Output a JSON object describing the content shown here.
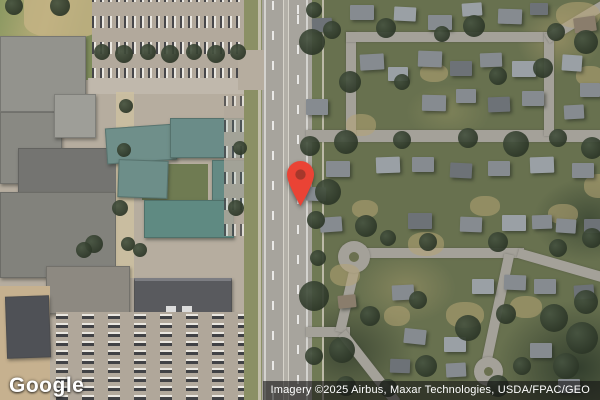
{
  "map": {
    "type": "satellite",
    "logo_text": "Google",
    "attribution_text": "Imagery ©2025 Airbus, Maxar Technologies, USDA/FPAC/GEO",
    "marker": {
      "color": "#EA4335",
      "inner_color": "#A6372B"
    },
    "colors": {
      "vegetation_dark": "#2c3627",
      "lawn_olive": "#68714f",
      "dry_grass": "#b5a474",
      "residential_road": "#a4a199",
      "highway": "#a7a49d",
      "campus_pavement": "#b6ad9f",
      "roof_gray": "#93938d",
      "roof_teal": "#668c86",
      "roof_dark": "#56575b"
    },
    "features": {
      "houses": [
        [
          312,
          18,
          20,
          14,
          -2,
          2
        ],
        [
          350,
          5,
          24,
          15,
          0,
          0
        ],
        [
          394,
          7,
          22,
          14,
          3,
          1
        ],
        [
          428,
          15,
          24,
          15,
          0,
          0
        ],
        [
          462,
          3,
          20,
          13,
          -4,
          1
        ],
        [
          498,
          9,
          24,
          15,
          2,
          0
        ],
        [
          530,
          3,
          18,
          12,
          0,
          2
        ],
        [
          574,
          17,
          22,
          15,
          -8,
          3
        ],
        [
          306,
          99,
          22,
          16,
          0,
          0
        ],
        [
          306,
          187,
          20,
          14,
          2,
          0
        ],
        [
          360,
          54,
          24,
          16,
          -3,
          0
        ],
        [
          388,
          67,
          20,
          14,
          0,
          1
        ],
        [
          418,
          51,
          24,
          16,
          2,
          0
        ],
        [
          450,
          61,
          22,
          15,
          0,
          2
        ],
        [
          480,
          53,
          22,
          14,
          -2,
          0
        ],
        [
          512,
          61,
          24,
          16,
          0,
          1
        ],
        [
          422,
          95,
          24,
          16,
          1,
          0
        ],
        [
          456,
          89,
          20,
          14,
          0,
          0
        ],
        [
          488,
          97,
          22,
          15,
          -2,
          2
        ],
        [
          522,
          91,
          22,
          15,
          0,
          0
        ],
        [
          562,
          55,
          20,
          16,
          4,
          1
        ],
        [
          580,
          83,
          20,
          14,
          0,
          0
        ],
        [
          564,
          105,
          20,
          14,
          -3,
          0
        ],
        [
          326,
          161,
          24,
          16,
          0,
          0
        ],
        [
          376,
          157,
          24,
          16,
          -2,
          1
        ],
        [
          412,
          157,
          22,
          15,
          0,
          0
        ],
        [
          450,
          163,
          22,
          15,
          3,
          2
        ],
        [
          488,
          161,
          22,
          15,
          0,
          0
        ],
        [
          530,
          157,
          24,
          16,
          -2,
          1
        ],
        [
          572,
          163,
          22,
          15,
          0,
          0
        ],
        [
          320,
          217,
          22,
          15,
          -4,
          0
        ],
        [
          408,
          213,
          24,
          16,
          0,
          2
        ],
        [
          460,
          217,
          22,
          15,
          2,
          0
        ],
        [
          502,
          215,
          24,
          16,
          0,
          1
        ],
        [
          532,
          215,
          20,
          14,
          -2,
          0
        ],
        [
          556,
          219,
          20,
          14,
          4,
          0
        ],
        [
          584,
          219,
          18,
          14,
          0,
          2
        ],
        [
          392,
          285,
          22,
          15,
          -3,
          0
        ],
        [
          472,
          279,
          22,
          15,
          0,
          1
        ],
        [
          504,
          275,
          22,
          15,
          2,
          0
        ],
        [
          534,
          279,
          22,
          15,
          0,
          0
        ],
        [
          574,
          285,
          20,
          14,
          -4,
          2
        ],
        [
          404,
          329,
          22,
          15,
          6,
          0
        ],
        [
          444,
          337,
          22,
          15,
          0,
          1
        ],
        [
          446,
          363,
          20,
          14,
          -3,
          0
        ],
        [
          530,
          343,
          22,
          15,
          0,
          0
        ],
        [
          390,
          359,
          20,
          14,
          2,
          2
        ],
        [
          558,
          379,
          22,
          14,
          0,
          0
        ],
        [
          338,
          295,
          18,
          13,
          -6,
          3
        ]
      ],
      "trees": [
        [
          312,
          42,
          26
        ],
        [
          332,
          30,
          18
        ],
        [
          386,
          28,
          20
        ],
        [
          442,
          34,
          16
        ],
        [
          474,
          26,
          22
        ],
        [
          556,
          32,
          18
        ],
        [
          350,
          82,
          22
        ],
        [
          402,
          82,
          16
        ],
        [
          498,
          76,
          18
        ],
        [
          543,
          68,
          20
        ],
        [
          586,
          42,
          24
        ],
        [
          310,
          146,
          20
        ],
        [
          346,
          142,
          24
        ],
        [
          402,
          140,
          18
        ],
        [
          468,
          138,
          20
        ],
        [
          516,
          144,
          26
        ],
        [
          558,
          138,
          18
        ],
        [
          592,
          148,
          22
        ],
        [
          328,
          192,
          26
        ],
        [
          366,
          226,
          22
        ],
        [
          388,
          238,
          16
        ],
        [
          428,
          242,
          18
        ],
        [
          498,
          242,
          20
        ],
        [
          558,
          248,
          18
        ],
        [
          592,
          238,
          20
        ],
        [
          314,
          296,
          30
        ],
        [
          342,
          350,
          26
        ],
        [
          370,
          316,
          20
        ],
        [
          418,
          300,
          18
        ],
        [
          426,
          366,
          22
        ],
        [
          468,
          328,
          26
        ],
        [
          506,
          314,
          20
        ],
        [
          522,
          366,
          18
        ],
        [
          554,
          318,
          28
        ],
        [
          582,
          338,
          32
        ],
        [
          586,
          302,
          24
        ],
        [
          566,
          366,
          26
        ],
        [
          498,
          386,
          22
        ],
        [
          388,
          388,
          18
        ],
        [
          346,
          386,
          20
        ],
        [
          314,
          10,
          16
        ],
        [
          316,
          220,
          18
        ],
        [
          318,
          258,
          16
        ],
        [
          314,
          356,
          18
        ]
      ],
      "campus_trees": [
        [
          102,
          52,
          16
        ],
        [
          124,
          54,
          18
        ],
        [
          148,
          52,
          16
        ],
        [
          170,
          54,
          18
        ],
        [
          194,
          52,
          16
        ],
        [
          216,
          54,
          18
        ],
        [
          238,
          52,
          16
        ],
        [
          126,
          106,
          14
        ],
        [
          124,
          150,
          14
        ],
        [
          120,
          208,
          16
        ],
        [
          128,
          244,
          14
        ],
        [
          94,
          244,
          18
        ],
        [
          236,
          208,
          16
        ],
        [
          240,
          148,
          14
        ],
        [
          60,
          6,
          20
        ],
        [
          14,
          6,
          18
        ],
        [
          84,
          250,
          16
        ],
        [
          140,
          250,
          14
        ]
      ],
      "dry_patches": [
        [
          556,
          2,
          44,
          26
        ],
        [
          346,
          114,
          30,
          22
        ],
        [
          408,
          232,
          36,
          24
        ],
        [
          330,
          264,
          30,
          22
        ],
        [
          548,
          204,
          30,
          20
        ],
        [
          584,
          174,
          30,
          24
        ],
        [
          446,
          302,
          38,
          26
        ],
        [
          510,
          296,
          32,
          22
        ],
        [
          384,
          306,
          26,
          20
        ],
        [
          576,
          66,
          28,
          20
        ],
        [
          352,
          200,
          26,
          18
        ],
        [
          470,
          196,
          30,
          20
        ],
        [
          420,
          64,
          28,
          18
        ]
      ]
    }
  }
}
